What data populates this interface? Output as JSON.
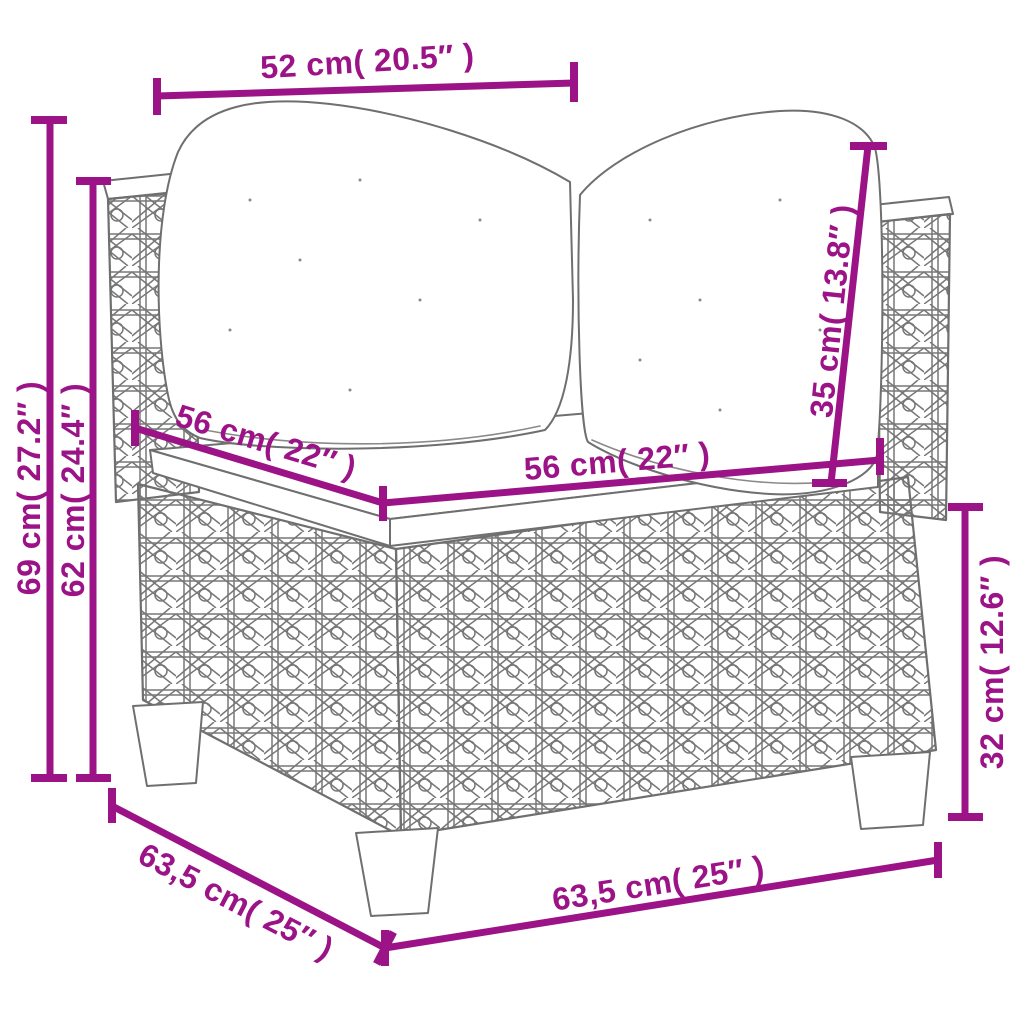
{
  "diagram": {
    "colors": {
      "dimension_accent": "#9B1386",
      "line_art": "#6F6F6F",
      "background": "#FFFFFF"
    },
    "dimensions": {
      "top_width": {
        "label": "52 cm( 20.5″ )"
      },
      "total_height": {
        "label": "69 cm( 27.2″ )"
      },
      "arm_height": {
        "label": "62 cm( 24.4″ )"
      },
      "seat_depth": {
        "label": "56 cm( 22″ )"
      },
      "seat_width": {
        "label": "56 cm( 22″ )"
      },
      "back_cushion": {
        "label": "35 cm( 13.8″ )"
      },
      "base_height": {
        "label": "32 cm( 12.6″ )"
      },
      "bottom_depth": {
        "label": "63,5 cm( 25″ )"
      },
      "bottom_width": {
        "label": "63,5 cm( 25″ )"
      }
    }
  }
}
